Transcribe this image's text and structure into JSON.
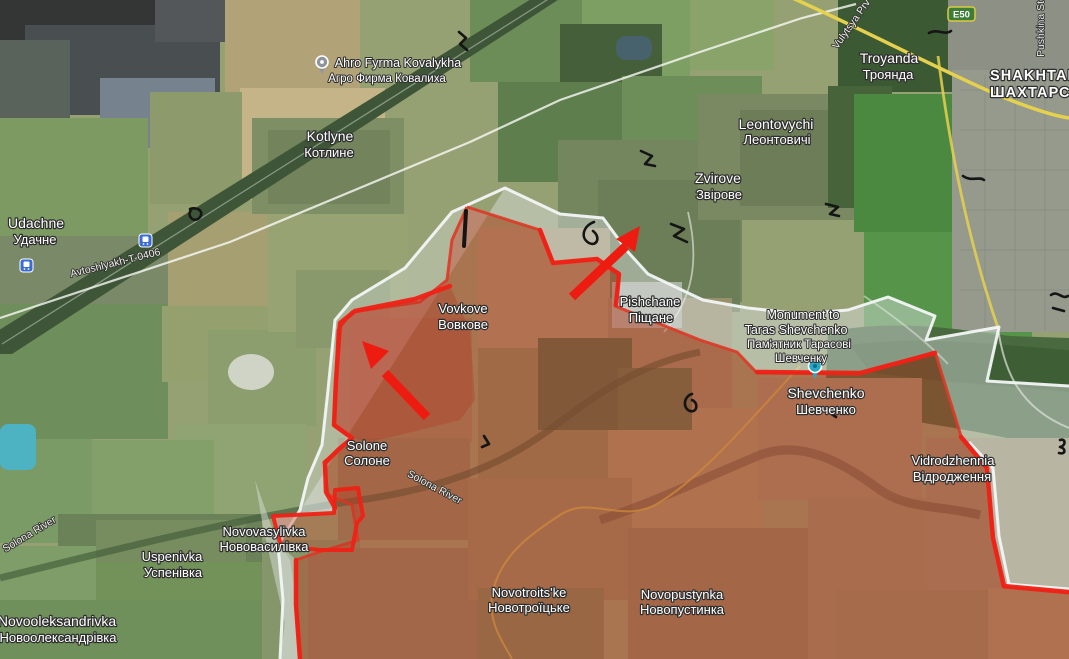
{
  "labels": {
    "ahro_fyrma": {
      "latin": "Ahro Fyrma Kovalykha",
      "cyrillic": "Агро Фирма Ковалиха"
    },
    "kotlyne": {
      "latin": "Kotlyne",
      "cyrillic": "Котлине"
    },
    "udachne": {
      "latin": "Udachne",
      "cyrillic": "Удачне"
    },
    "troyanda": {
      "latin": "Troyanda",
      "cyrillic": "Троянда"
    },
    "shakhtarske": {
      "latin": "SHAKHTARSK",
      "cyrillic": "ШАХТАРСЬКИ"
    },
    "leontovychi": {
      "latin": "Leontovychi",
      "cyrillic": "Леонтовичі"
    },
    "zvirove": {
      "latin": "Zvirove",
      "cyrillic": "Звірове"
    },
    "vovkove": {
      "latin": "Vovkove",
      "cyrillic": "Вовкове"
    },
    "pishchane": {
      "latin": "Pishchane",
      "cyrillic": "Піщане"
    },
    "monument": {
      "line1": "Monument to",
      "line2": "Taras Shevchenko",
      "line3": "Пам'ятник Тарасові",
      "line4": "Шевченку"
    },
    "shevchenko": {
      "latin": "Shevchenko",
      "cyrillic": "Шевченко"
    },
    "vidrodzhennia": {
      "latin": "Vidrodzhennia",
      "cyrillic": "Відродження"
    },
    "solone": {
      "latin": "Solone",
      "cyrillic": "Солоне"
    },
    "uspenivka": {
      "latin": "Uspenivka",
      "cyrillic": "Успенівка"
    },
    "novovasylivka": {
      "latin": "Novovasylivka",
      "cyrillic": "Нововасилівка"
    },
    "novooleksandrivka": {
      "latin": "Novooleksandrivka",
      "cyrillic": "Новоолександрівка"
    },
    "novotroitske": {
      "latin": "Novotroits'ke",
      "cyrillic": "Новотроїцьке"
    },
    "novopustynka": {
      "latin": "Novopustynka",
      "cyrillic": "Новопустинка"
    }
  },
  "roads": {
    "avtoshlyakh": "Avtoshlyakh-T-0406",
    "e50": "E50",
    "pushkina": "Pushkina St",
    "vulytsya_prv": "Vulytsya Prv",
    "solona_river": "Solona River"
  },
  "overlay": {
    "red_zone_fill": "#c03a22",
    "red_zone_border": "#dd3826",
    "advance_line": "#ef2115",
    "arrow_color": "#ee1c10",
    "gray_zone_fill": "#dde3e2",
    "gray_zone_border": "#f2f6f5"
  },
  "icons": {
    "station": "train-station-icon",
    "poi_gray": "poi-pin-icon",
    "poi_teal": "monument-pin-icon",
    "route_badge": "e-road-shield"
  }
}
